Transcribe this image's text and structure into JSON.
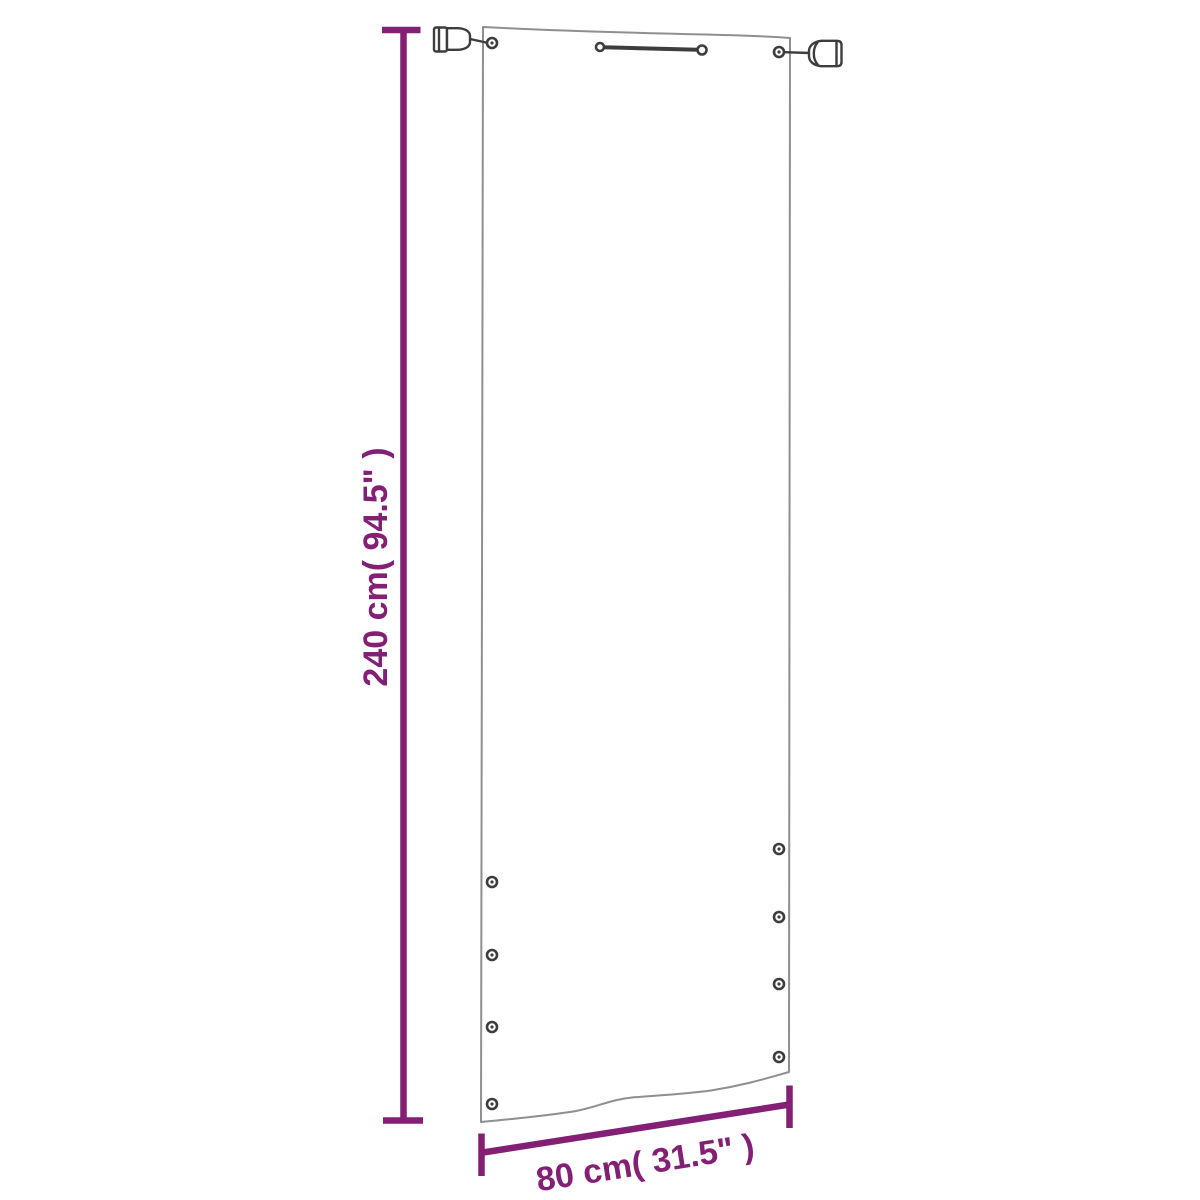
{
  "diagram": {
    "labels": {
      "height": "240 cm( 94.5\" )",
      "width": "80 cm( 31.5\" )"
    },
    "colors": {
      "dimension": "#831f74",
      "outline": "#8f8f8f",
      "hardware": "#3d3d3d",
      "background": "#ffffff"
    }
  }
}
